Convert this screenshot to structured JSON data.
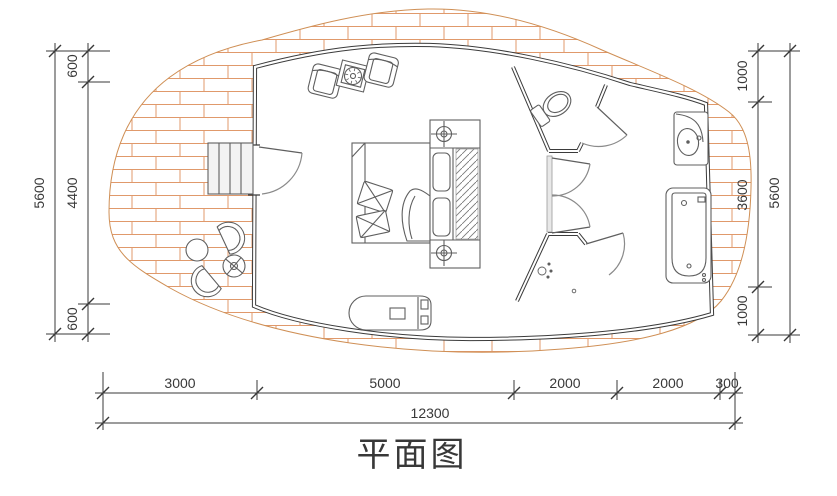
{
  "title": "平面图",
  "colors": {
    "wall_line": "#3b3b3b",
    "furniture_line": "#5f5f5f",
    "deck_brick": "#e0996b",
    "dimension_line": "#383838"
  },
  "dimensions": {
    "left": {
      "segments": [
        "600",
        "4400",
        "600"
      ],
      "total": "5600"
    },
    "right": {
      "segments": [
        "1000",
        "3600",
        "1000"
      ],
      "total": "5600"
    },
    "bottom": {
      "segments": [
        "3000",
        "5000",
        "2000",
        "2000",
        "300"
      ],
      "total": "12300"
    }
  }
}
